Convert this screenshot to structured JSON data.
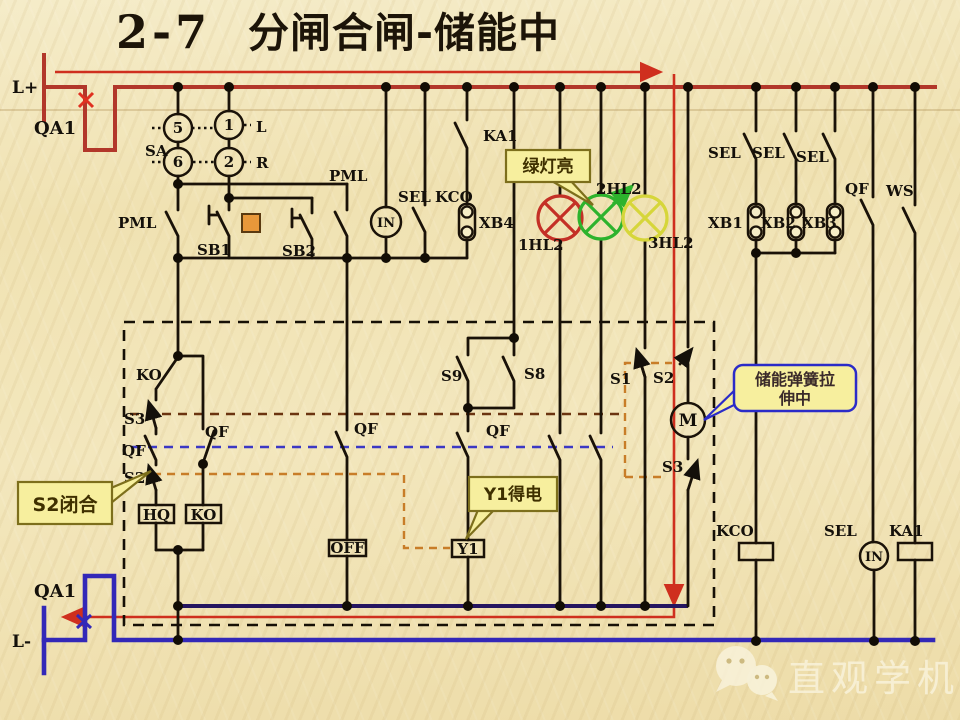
{
  "title": {
    "number": "2-7",
    "text": "分闸合闸-储能中"
  },
  "terminals": {
    "top": "L+",
    "bottom": "L-",
    "breaker": "QA1"
  },
  "selector": {
    "name": "SA",
    "contacts": [
      "5",
      "6",
      "1",
      "2"
    ],
    "left_pos": "L",
    "right_pos": "R"
  },
  "labels": {
    "pml": "PML",
    "sb1": "SB1",
    "sb2": "SB2",
    "in": "IN",
    "sel": "SEL",
    "kco": "KCO",
    "ka1": "KA1",
    "xb1": "XB1",
    "xb2": "XB2",
    "xb3": "XB3",
    "xb4": "XB4",
    "hl1": "1HL2",
    "hl2": "2HL2",
    "hl3": "3HL2",
    "qf": "QF",
    "ws": "WS",
    "s1": "S1",
    "s2": "S2",
    "s3": "S3",
    "s8": "S8",
    "s9": "S9",
    "ko": "KO",
    "hq": "HQ",
    "off": "OFF",
    "y1": "Y1",
    "m": "M"
  },
  "callouts": {
    "green_light": "绿灯亮",
    "spring_line1": "储能弹簧拉",
    "spring_line2": "伸中",
    "y1_energized": "Y1得电",
    "s2_closed": "S2闭合"
  },
  "watermark": {
    "text": "直观学机械"
  },
  "colors": {
    "busred": "#b2372a",
    "hlred": "#cf2f1e",
    "busblue": "#3328b8",
    "navy": "#251560",
    "wire": "#1a1208",
    "lampred": "#c43026",
    "lampgreen": "#2db32d",
    "lampyellow": "#d6d63a",
    "cfill": "#f7ef9e",
    "cborder": "#7d6f1c",
    "springborder": "#2b2bc8",
    "dorange": "#c87d28",
    "dbrown": "#6b3410",
    "dblue": "#3c38c4",
    "btnorange": "#e8983a"
  }
}
